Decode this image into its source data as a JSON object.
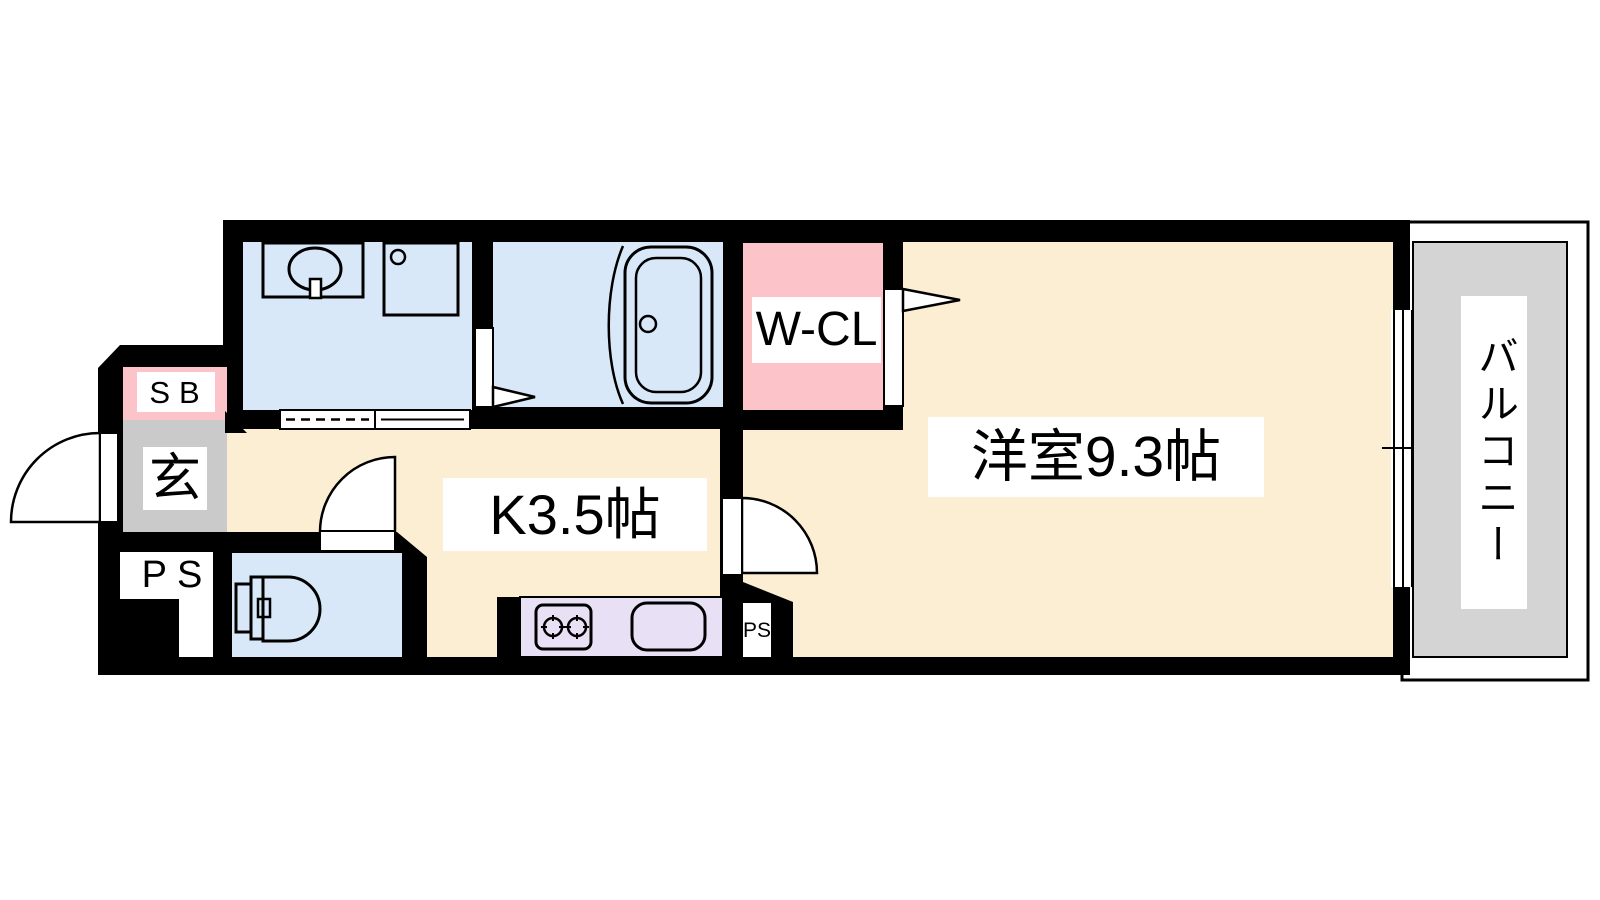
{
  "plan_type": "apartment-floor-plan",
  "colors": {
    "wall": "#000000",
    "line": "#000000",
    "floor_cream": "#FBEED2",
    "wet_area_blue": "#D9E8F9",
    "closet_pink": "#FCC3C8",
    "counter_purple": "#E8E0F5",
    "genkan_gray": "#CACACA",
    "balcony_gray": "#D4D4D4",
    "label_bg": "#FFFFFF",
    "door_white": "#FFFFFF"
  },
  "labels": {
    "shoe_box": "SB",
    "entrance": "玄",
    "pipe_space_left": "PS",
    "kitchen": "K3.5帖",
    "walk_in_closet": "W-CL",
    "main_room": "洋室9.3帖",
    "balcony": "バルコニー",
    "pipe_space_bottom": "PS"
  }
}
